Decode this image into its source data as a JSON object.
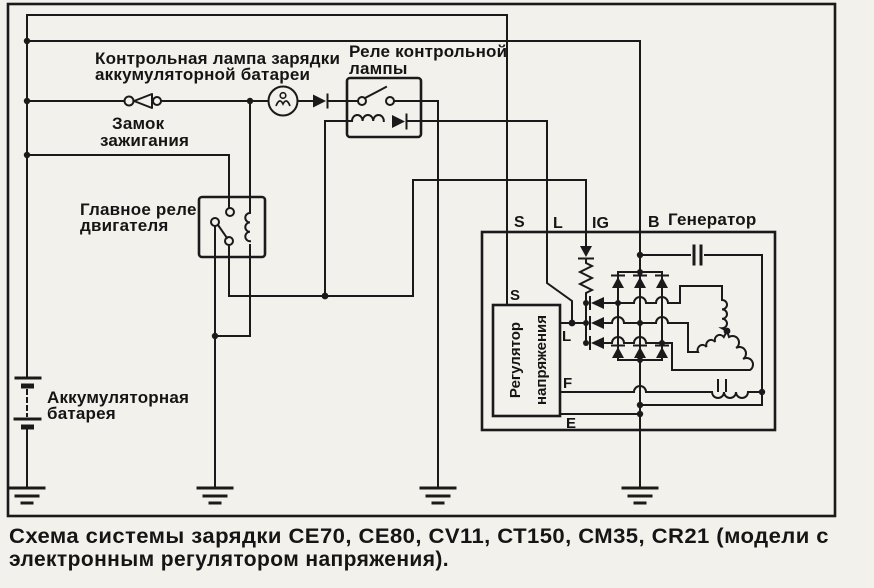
{
  "figure": {
    "type": "wiring-schematic",
    "caption_line1": "Схема системы зарядки СЕ70, СЕ80, CV11, СТ150, СМ35, CR21 (модели с",
    "caption_line2": "электронным регулятором напряжения).",
    "labels": {
      "charge_lamp_1": "Контрольная лампа зарядки",
      "charge_lamp_2": "аккумуляторной батареи",
      "lamp_relay_1": "Реле контрольной",
      "lamp_relay_2": "лампы",
      "ignition_1": "Замок",
      "ignition_2": "зажигания",
      "main_relay_1": "Главное реле",
      "main_relay_2": "двигателя",
      "battery_1": "Аккумуляторная",
      "battery_2": "батарея",
      "generator": "Генератор",
      "regulator_1": "Регулятор",
      "regulator_2": "напряжения"
    },
    "terminals": {
      "s": "S",
      "l": "L",
      "ig": "IG",
      "b": "B"
    },
    "regulator_terminals": {
      "s": "S",
      "l": "L",
      "f": "F",
      "e": "E"
    },
    "ink_color": "#1a1a1a",
    "paper_color": "#f3f1ec"
  }
}
